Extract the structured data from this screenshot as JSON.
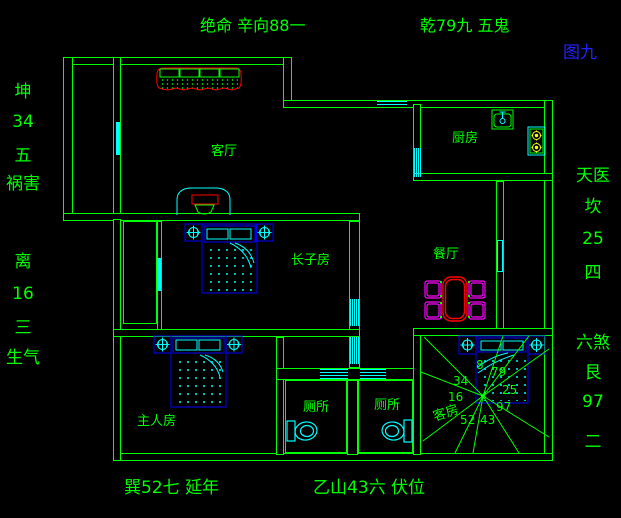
{
  "annotations": {
    "top_left": "绝命 辛向88一",
    "top_right": "乾79九 五鬼",
    "figure_number": "图九",
    "left_column": [
      "坤",
      "34",
      "五",
      "祸害",
      "离",
      "16",
      "三",
      "生气"
    ],
    "right_column": [
      "天医",
      "坎",
      "25",
      "四",
      "六煞",
      "艮",
      "97",
      "二"
    ],
    "bottom_left": "巽52七 延年",
    "bottom_right": "乙山43六 伏位"
  },
  "room_labels": {
    "living_room": "客厅",
    "kitchen": "厨房",
    "eldest_son_room": "长子房",
    "dining_room": "餐厅",
    "master_bedroom": "主人房",
    "toilet_1": "厕所",
    "toilet_2": "厕所",
    "guest_room": "客房"
  },
  "compass_numbers": {
    "upper": "8",
    "upper_right": "79",
    "left_upper": "34",
    "right": "25",
    "left": "16",
    "lower_right": "97",
    "bottom_left": "52",
    "bottom_right": "43"
  },
  "colors": {
    "wall": "#00ff00",
    "fixture": "#00ffff",
    "furniture_frame": "#0000ff",
    "sofa_outline": "#ff0000",
    "chair": "#ff00ff",
    "burner": "#ffff00",
    "figure_number": "#2222ff",
    "background": "#000000"
  }
}
